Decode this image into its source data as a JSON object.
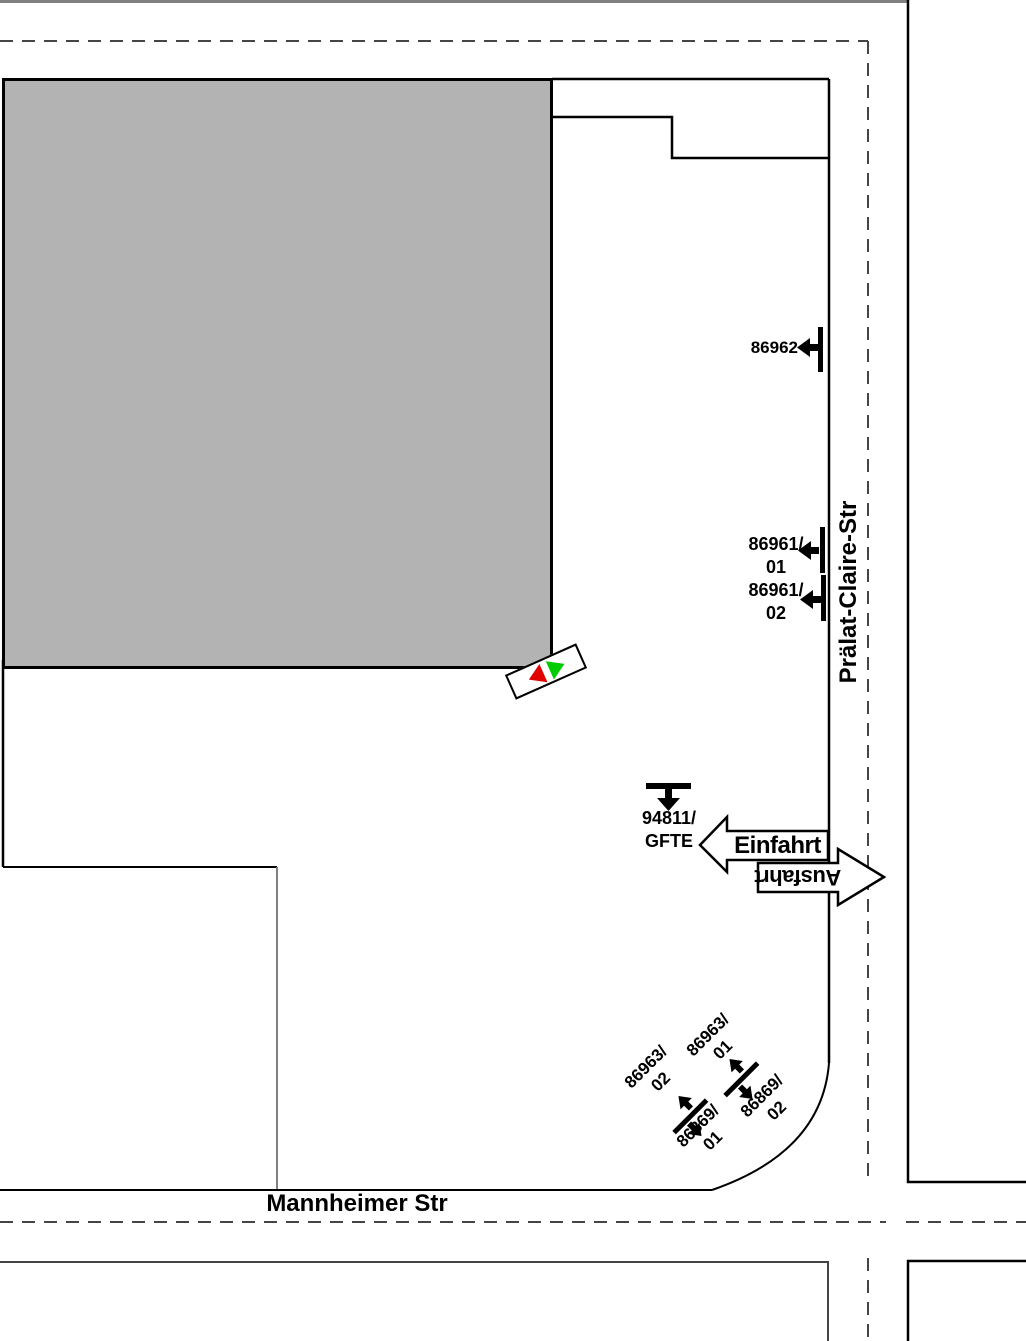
{
  "streets": {
    "pralat_claire": "Prälat-Claire-Str",
    "mannheimer": "Mannheimer Str"
  },
  "access": {
    "entry_label": "Einfahrt",
    "exit_label": "Ausfahrt"
  },
  "billboards": {
    "b86962": {
      "label": "86962"
    },
    "b86961_01": {
      "line1": "86961/",
      "line2": "01"
    },
    "b86961_02": {
      "line1": "86961/",
      "line2": "02"
    },
    "b94811": {
      "line1": "94811/",
      "line2": "GFTE"
    },
    "b86963_01": {
      "line1": "86963/",
      "line2": "01"
    },
    "b86963_02": {
      "line1": "86963/",
      "line2": "02"
    },
    "b86869_01": {
      "line1": "86869/",
      "line2": "01"
    },
    "b86869_02": {
      "line1": "86869/",
      "line2": "02"
    }
  },
  "colors": {
    "building_fill": "#b3b3b3",
    "line_black": "#000000",
    "dashed_gray": "#454545",
    "boundary_gray": "#808080",
    "signal_red": "#e00000",
    "signal_green": "#00cc00"
  }
}
